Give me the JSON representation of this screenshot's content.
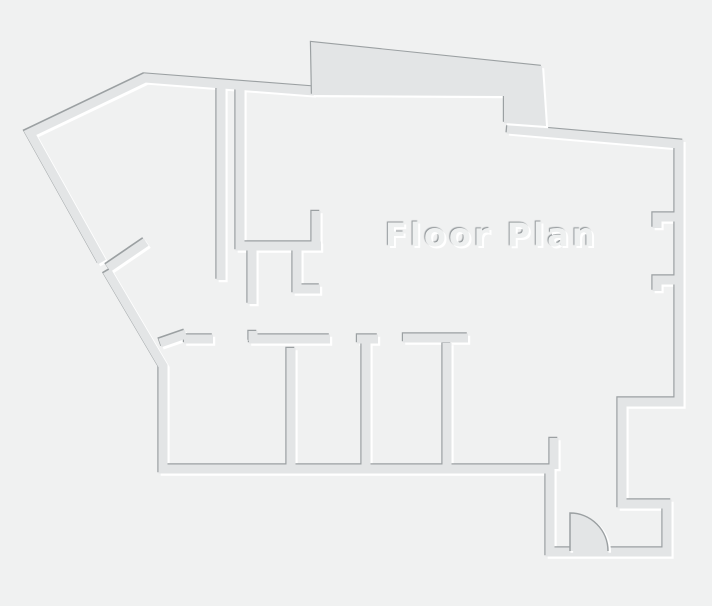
{
  "title": {
    "label": "Floor Plan"
  },
  "colors": {
    "background": "#f0f1f1",
    "wall_body": "#e3e5e6",
    "wall_edge_dark": "#9ba0a2",
    "wall_edge_light": "#ffffff",
    "title_text": "#eef0f0"
  },
  "floorplan": {
    "canvas": {
      "width": 712,
      "height": 606
    },
    "walls_path": "M102,262 L30,133 L145,78 L314,91 M507,129 L679,144 L679,402 L622,402 L622,504 L667,504 L667,552 L550,552 L550,469 L163,469 L163,366 L107,271 M108,268 L146,242 M221,86 L221,280 M240,86 L240,246 L321,246 M316,248 L316,211 M252,248 L252,304 M297,248 L297,289 L320,289 M160,343 L186,334 M184,339 L213,339 M253,331 L253,341 M249,339 L330,339 M357,339 L378,339 M366,341 L366,467 M403,338 L468,338 M291,348 L291,467 M447,343 L447,467 M554,438 L554,469 M678,217 L657,217 L657,228 M678,280 L657,280 L657,291",
    "bay_polygon": "311,42 542,66 546,126 504,123 504,96 312,95",
    "door": {
      "body_path": "M570,513 A38,38 0 0 1 608,551 L570,551 Z",
      "edge_path": "M570,551 L570,513 A38,38 0 0 1 608,551"
    }
  }
}
